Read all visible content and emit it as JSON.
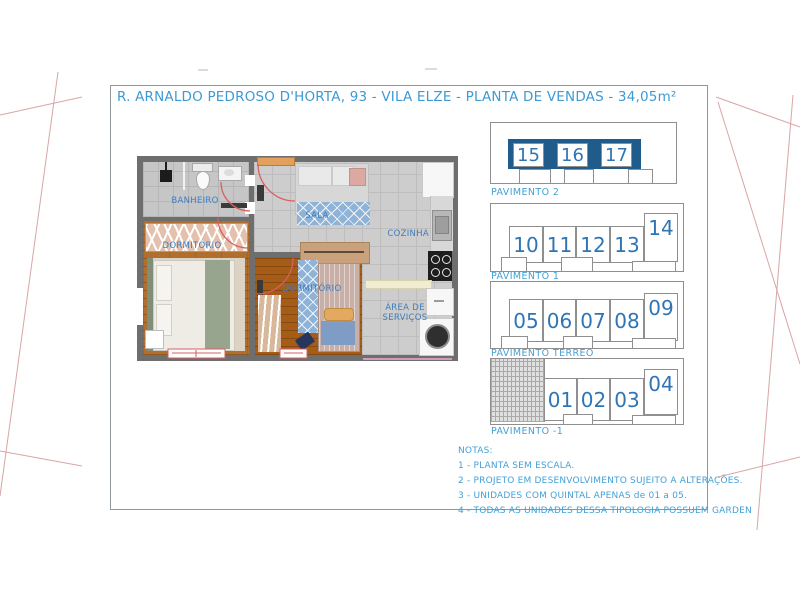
{
  "title": "R. ARNALDO PEDROSO D'HORTA, 93 - VILA ELZE - PLANTA DE VENDAS - 34,05m²",
  "floor_plan": {
    "rooms": {
      "banheiro": "BANHEIRO",
      "dormitorio_1": "DORMITÓRIO",
      "sala": "SALA",
      "cozinha": "COZINHA",
      "dormitorio_2": "DORMITÓRIO",
      "area_servicos_line1": "ÁREA DE",
      "area_servicos_line2": "SERVIÇOS"
    }
  },
  "pavimentos": [
    {
      "label": "PAVIMENTO 2",
      "units": [
        "15",
        "16",
        "17"
      ],
      "highlighted": true
    },
    {
      "label": "PAVIMENTO 1",
      "units": [
        "10",
        "11",
        "12",
        "13",
        "14"
      ],
      "highlighted": false
    },
    {
      "label": "PAVIMENTO TERREO",
      "units": [
        "05",
        "06",
        "07",
        "08",
        "09"
      ],
      "highlighted": false
    },
    {
      "label": "PAVIMENTO -1",
      "units": [
        "01",
        "02",
        "03",
        "04"
      ],
      "highlighted": false,
      "hatched_area": true
    }
  ],
  "notes": {
    "header": "NOTAS:",
    "items": [
      "1 - PLANTA SEM ESCALA.",
      "2 - PROJETO EM DESENVOLVIMENTO SUJEITO A ALTERAÇÕES.",
      "3 - UNIDADES COM QUINTAL APENAS de 01 a 05.",
      "4 - TODAS AS UNIDADES DESSA TIPOLOGIA POSSUEM GARDEN"
    ]
  },
  "colors": {
    "title_blue": "#3d9ad3",
    "label_blue": "#44a0d6",
    "unit_number_blue": "#2f75b5",
    "room_label_blue": "#3e7dbf",
    "highlight_dark_blue": "#1f5c8c",
    "mark_red": "#d95f5f"
  }
}
